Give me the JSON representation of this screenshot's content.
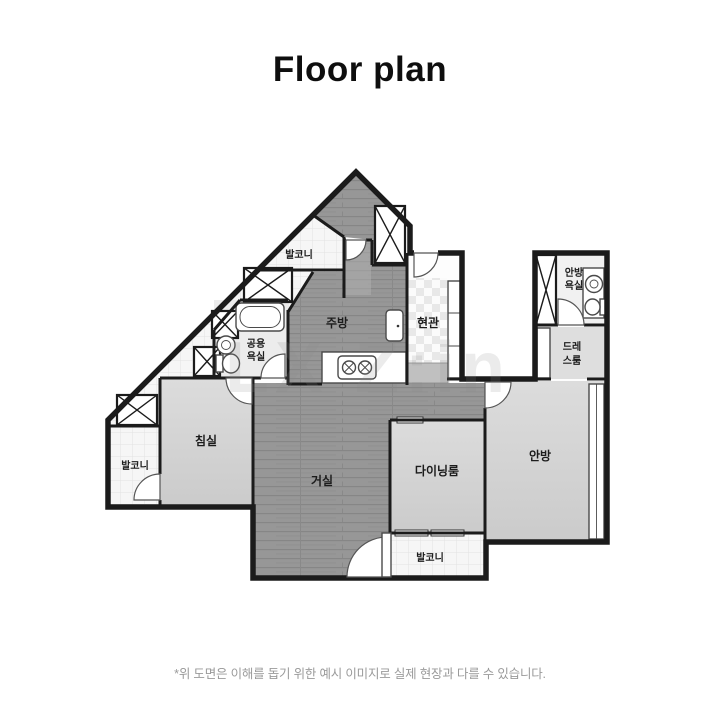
{
  "title": "Floor plan",
  "disclaimer": "*위 도면은 이해를 돕기 위한 예시 이미지로 실제 현장과 다를 수 있습니다.",
  "watermark": "LX Z:in",
  "colors": {
    "wall": "#1b1b1b",
    "wood_floor": "#969696",
    "light_room": "#d6d6d6",
    "tile": "#f6f6f6",
    "title_text": "#0e0e0e",
    "disclaimer_text": "#9a9a9a"
  },
  "rooms": {
    "balcony_top": "발코니",
    "kitchen": "주방",
    "entrance": "현관",
    "master_bath": {
      "line1": "안방",
      "line2": "욕실"
    },
    "common_bath": {
      "line1": "공용",
      "line2": "욕실"
    },
    "dressroom": {
      "line1": "드레",
      "line2": "스룸"
    },
    "bedroom": "침실",
    "balcony_left": "발코니",
    "living": "거실",
    "dining": "다이닝룸",
    "master_bedroom": "안방",
    "balcony_bottom": "발코니"
  }
}
